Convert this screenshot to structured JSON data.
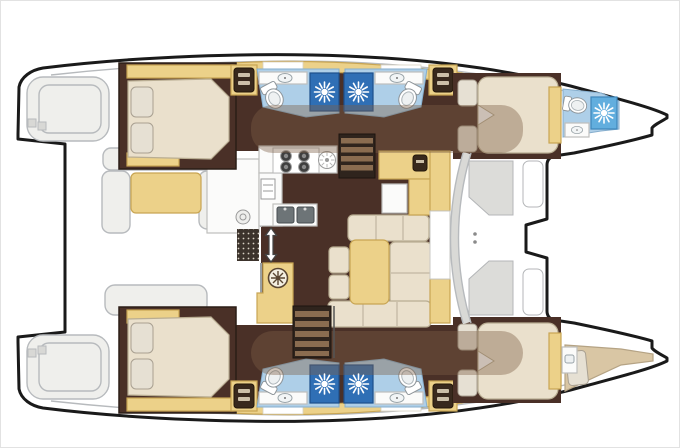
{
  "meta": {
    "title": "Catamaran interior layout floor plan, top view, bows to the right",
    "orientation": {
      "bow": "right",
      "stern": "left"
    },
    "visible_text": []
  },
  "palette": {
    "outline": "#1a1a1a",
    "exterior_line": "#b7babd",
    "exterior_fill": "#efefec",
    "hull_floor": "#4a3027",
    "furniture_tan": "#ecd189",
    "furniture_tan_edge": "#c8a553",
    "mattress_cream": "#eae0cc",
    "mattress_edge": "#b9ad92",
    "pillow": "#e6e0d3",
    "crew_mattress": "#d9c6a4",
    "head_floor": "#aecfe8",
    "head_floor_edge": "#86aecd",
    "shower_dark": "#2f6fb5",
    "shower_light": "#62aede",
    "counter_white": "#fbfbfa",
    "steel_gray": "#6d7477",
    "stair_dark": "#2f241d",
    "stair_tread": "#8a6c50",
    "roof_shadow": "#7c5f45"
  },
  "rooms": {
    "aft_cockpit": {
      "label": "Aft cockpit with bench seating and table"
    },
    "port_stern_steps": {
      "label": "Port transom swim steps"
    },
    "starboard_stern_steps": {
      "label": "Starboard transom swim steps"
    },
    "salon": {
      "label": "Salon with U-shaped dinette and table"
    },
    "galley": {
      "label": "Galley with 4-burner stove, round sink, double sink and oven"
    },
    "nav_station": {
      "label": "Chart table sideboard with seat"
    },
    "forward_cockpit": {
      "label": "Forward cockpit with moulded benches behind curved windshield"
    },
    "trampoline": {
      "label": "Foredeck between bows"
    },
    "port_aft_cabin": {
      "label": "Port aft double cabin"
    },
    "port_aft_head": {
      "label": "Port aft bathroom: shower, toilet, washbasin"
    },
    "port_forward_head": {
      "label": "Port forward bathroom: shower, toilet, washbasin"
    },
    "port_forward_cabin": {
      "label": "Port forward double cabin"
    },
    "port_bow_head": {
      "label": "Port bow bathroom with shower and toilet"
    },
    "starboard_aft_cabin": {
      "label": "Starboard aft double cabin"
    },
    "starboard_aft_head": {
      "label": "Starboard aft bathroom: shower, toilet, washbasin"
    },
    "starboard_forward_head": {
      "label": "Starboard forward bathroom: shower, toilet, washbasin"
    },
    "starboard_forward_cabin": {
      "label": "Starboard forward double cabin"
    },
    "bow_crew_berth": {
      "label": "Starboard bow crew berth"
    },
    "port_companionway": {
      "label": "Steps down into port hull"
    },
    "starboard_companionway": {
      "label": "Steps down into starboard hull"
    },
    "entry_door": {
      "label": "Cockpit sliding-door entry with direction arrow"
    }
  },
  "icons": {
    "shower": "sunburst-drain-icon",
    "toilet": "toilet-icon",
    "sink": "washbasin-icon",
    "round_sink": "round-sink-icon",
    "stove": "four-burner-stove-icon",
    "double_sink": "double-sink-icon",
    "oven": "oven-icon",
    "vanity": "dresser-icon",
    "vent": "round-vent-icon",
    "arrow": "up-down-arrow-icon",
    "stairs": "companionway-steps-icon"
  }
}
